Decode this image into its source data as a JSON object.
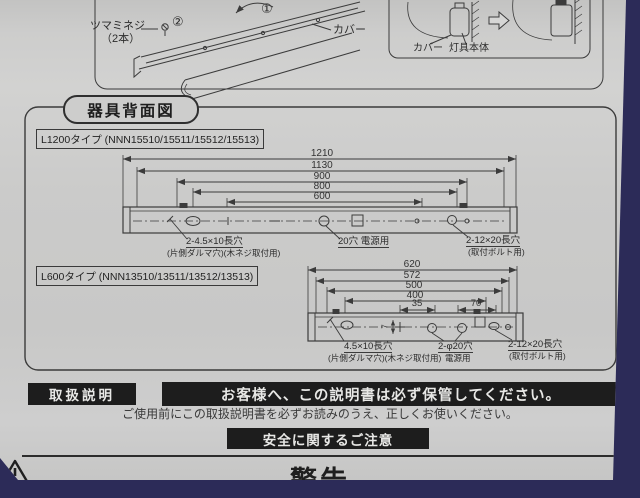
{
  "colors": {
    "background": "#2c2b58",
    "paper": "#cbcbca",
    "ink": "#2e2e2e",
    "black_bar": "#1d1d1d"
  },
  "top_section": {
    "thumb_screw_label_line1": "ツマミネジ",
    "thumb_screw_label_line2": "（2本）",
    "step_1": "①",
    "step_2": "②",
    "cover_label": "カバー",
    "inset": {
      "cover_label": "カバー",
      "body_label": "灯具本体"
    }
  },
  "rear_view": {
    "section_title": "器具背面図",
    "l1200": {
      "type_label": "L1200タイプ (NNN15510/15511/15512/15513)",
      "dims": [
        "1210",
        "1130",
        "900",
        "800",
        "600"
      ],
      "labels": {
        "left_hole_1": "2-4.5×10長穴",
        "left_hole_2": "(片側ダルマ穴)(木ネジ取付用)",
        "center_hole": "20穴 電源用",
        "right_hole_1": "2-12×20長穴",
        "right_hole_2": "(取付ボルト用)"
      }
    },
    "l600": {
      "type_label": "L600タイプ (NNN13510/13511/13512/13513)",
      "dims": [
        "620",
        "572",
        "500",
        "400",
        "35",
        "70"
      ],
      "dim_vertical": "7",
      "labels": {
        "left_hole_1": "4.5×10長穴",
        "left_hole_2": "(片側ダルマ穴)(木ネジ取付用)",
        "center_hole_1": "2-φ20穴",
        "center_hole_2": "電源用",
        "right_hole_1": "2-12×20長穴",
        "right_hole_2": "(取付ボルト用)"
      }
    }
  },
  "handling": {
    "section_label": "取扱説明",
    "notice_bar": "お客様へ、この説明書は必ず保管してください。",
    "notice_sub": "ご使用前にこの取扱説明書を必ずお読みのうえ、正しくお使いください。"
  },
  "safety": {
    "title": "安全に関するご注意",
    "warning": "警告"
  }
}
